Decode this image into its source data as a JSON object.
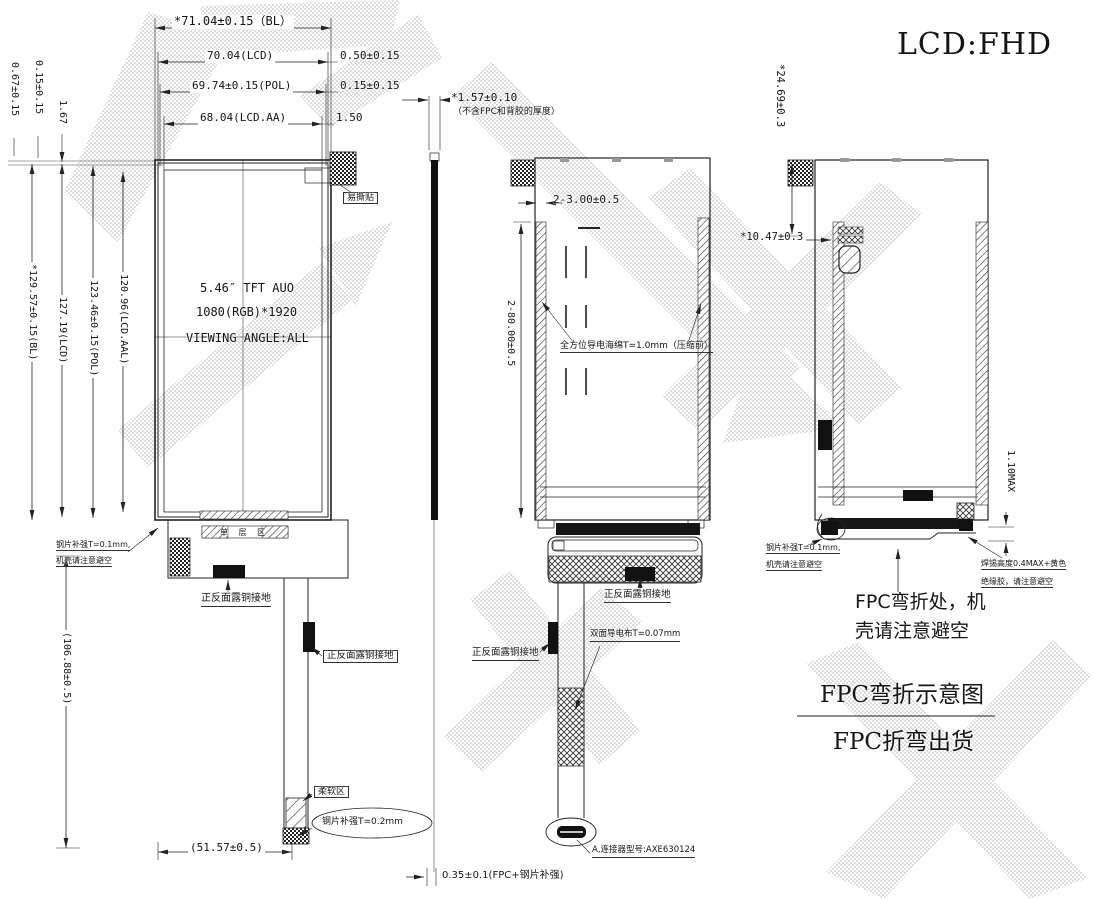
{
  "drawing": {
    "product_title": "LCD:FHD",
    "front": {
      "dim_bl_w": "*71.04±0.15（BL）",
      "dim_lcd_w": "70.04(LCD)",
      "dim_pol_w": "69.74±0.15(POL)",
      "dim_aa_w": "68.04(LCD.AA)",
      "gap_050": "0.50±0.15",
      "gap_015": "0.15±0.15",
      "gap_150": "1.50",
      "gap_067": "0.67±0.15",
      "gap_015l": "0.15±0.15",
      "gap_167": "1.67",
      "dim_bl_h": "*129.57±0.15(BL)",
      "dim_lcd_h": "127.19(LCD)",
      "dim_pol_h": "123.46±0.15(POL)",
      "dim_aa_h": "120.96(LCD.AAL)",
      "spec_line1": "5.46″ TFT AUO",
      "spec_line2": "1080(RGB)*1920",
      "spec_line3": "VIEWING ANGLE:ALL",
      "sticker": "易撕贴",
      "single_layer": "单 层 区",
      "steel_note1": "钢片补强T=0.1mm,",
      "steel_note2": "机壳请注意避空",
      "copper_top": "正反面露铜接地",
      "copper_side": "正反面露铜接地",
      "soft_zone": "柔软区",
      "steel_02": "钢片补强T=0.2mm",
      "dim_fpc_w": "(51.57±0.5)",
      "dim_fpc_h": "(106.88±0.5)"
    },
    "side": {
      "dim_thickness": "*1.57±0.10",
      "thickness_note": "（不含FPC和背胶的厚度）",
      "dim_fpc": "0.35±0.1(FPC+钢片补强)"
    },
    "back": {
      "dim_holes_w": "2-3.00±0.5",
      "dim_holes_h": "2-80.00±0.5",
      "foam_note": "全方位导电海绵T=1.0mm（压缩前）",
      "copper_top": "正反面露铜接地",
      "cloth_note": "双面导电布T=0.07mm",
      "copper_side": "正反面露铜接地",
      "connector_note": "A,连接器型号:AXE630124"
    },
    "fold": {
      "dim_fold_h": "*24.69±0.3",
      "dim_fold_w": "*10.47±0.3",
      "dim_max": "1.10MAX",
      "steel_note1": "钢片补强T=0.1mm,",
      "steel_note2": "机壳请注意避空",
      "solder_note1": "焊锡高度0.4MAX+黄色",
      "solder_note2": "绝缘胶，请注意避空",
      "bend_note1": "FPC弯折处，机",
      "bend_note2": "壳请注意避空",
      "caption_top": "FPC弯折示意图",
      "caption_bottom": "FPC折弯出货"
    },
    "colors": {
      "line": "#222222",
      "watermark": "#c9c9c9"
    }
  }
}
